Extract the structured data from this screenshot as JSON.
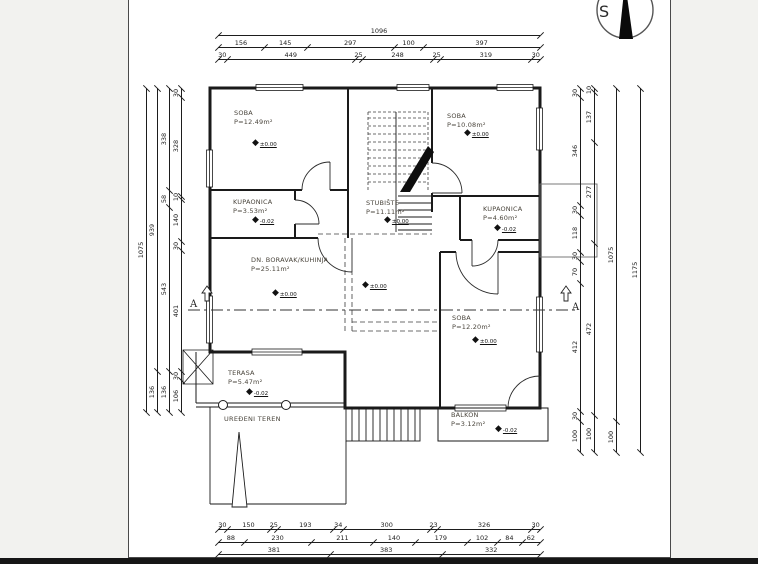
{
  "page": {
    "bg": "#f2f2ef",
    "sheet_bg": "#ffffff",
    "ink": "#1d1d1d"
  },
  "compass": {
    "label": "S"
  },
  "section_marker": {
    "label": "A"
  },
  "site_label": {
    "text": "UREĐENI TEREN"
  },
  "rooms": [
    {
      "id": "soba-tl",
      "name": "SOBA",
      "area": "P=12.49m²",
      "x": 234,
      "y": 109,
      "level": "±0.00",
      "lx": 252,
      "ly": 139
    },
    {
      "id": "kupaonica-left",
      "name": "KUPAONICA",
      "area": "P=3.53m²",
      "x": 233,
      "y": 198,
      "level": "-0.02",
      "lx": 252,
      "ly": 216
    },
    {
      "id": "stubiste",
      "name": "STUBIŠTE",
      "area": "P=11.11m²",
      "x": 366,
      "y": 199,
      "level": "±0.00",
      "lx": 384,
      "ly": 216
    },
    {
      "id": "soba-tr",
      "name": "SOBA",
      "area": "P=10.08m²",
      "x": 447,
      "y": 112,
      "level": "±0.00",
      "lx": 464,
      "ly": 129
    },
    {
      "id": "kupaonica-right",
      "name": "KUPAONICA",
      "area": "P=4.60m²",
      "x": 483,
      "y": 205,
      "level": "-0.02",
      "lx": 494,
      "ly": 224
    },
    {
      "id": "dn-boravak-kuhinja",
      "name": "DN. BORAVAK/KUHINJA",
      "area": "P=25.11m²",
      "x": 251,
      "y": 256,
      "level": "±0.00",
      "lx": 272,
      "ly": 289
    },
    {
      "id": "soba-br",
      "name": "SOBA",
      "area": "P=12.20m²",
      "x": 452,
      "y": 314,
      "level": "±0.00",
      "lx": 472,
      "ly": 336
    },
    {
      "id": "terasa",
      "name": "TERASA",
      "area": "P=5.47m²",
      "x": 228,
      "y": 369,
      "level": "-0.02",
      "lx": 246,
      "ly": 388
    },
    {
      "id": "balkon",
      "name": "BALKON",
      "area": "P=3.12m²",
      "x": 451,
      "y": 411,
      "level": "-0.02",
      "lx": 495,
      "ly": 425
    }
  ],
  "extra_levels": [
    {
      "value": "±0.00",
      "x": 362,
      "y": 281
    }
  ],
  "dims": {
    "rows": [
      {
        "id": "top-total",
        "dir": "h",
        "x": 218,
        "y": 35,
        "len": 322,
        "values": [
          "1096"
        ]
      },
      {
        "id": "top-mid",
        "dir": "h",
        "x": 218,
        "y": 47,
        "len": 322,
        "values": [
          "156",
          "145",
          "297",
          "100",
          "397"
        ]
      },
      {
        "id": "top-inner",
        "dir": "h",
        "x": 218,
        "y": 59,
        "len": 322,
        "values": [
          "30",
          "449",
          "25",
          "248",
          "25",
          "319",
          "30"
        ]
      },
      {
        "id": "bottom-inner",
        "dir": "h",
        "x": 218,
        "y": 529,
        "len": 322,
        "values": [
          "30",
          "150",
          "25",
          "193",
          "34",
          "300",
          "23",
          "326",
          "30"
        ]
      },
      {
        "id": "bottom-mid",
        "dir": "h",
        "x": 218,
        "y": 542,
        "len": 322,
        "values": [
          "88",
          "230",
          "211",
          "140",
          "179",
          "102",
          "84",
          "62"
        ]
      },
      {
        "id": "bottom-total",
        "dir": "h",
        "x": 218,
        "y": 554,
        "len": 322,
        "values": [
          "381",
          "383",
          "332"
        ]
      },
      {
        "id": "left-outer",
        "dir": "v",
        "x": 146,
        "y": 88,
        "len": 324,
        "values": [
          "1075"
        ]
      },
      {
        "id": "left-mid2",
        "dir": "v",
        "x": 157,
        "y": 88,
        "len": 324,
        "values": [
          "939",
          "136"
        ]
      },
      {
        "id": "left-mid1",
        "dir": "v",
        "x": 169,
        "y": 88,
        "len": 324,
        "values": [
          "338",
          "58",
          "543",
          "136"
        ]
      },
      {
        "id": "left-inner",
        "dir": "v",
        "x": 181,
        "y": 88,
        "len": 324,
        "values": [
          "30",
          "328",
          "10",
          "140",
          "30",
          "401",
          "30",
          "106"
        ]
      },
      {
        "id": "right-inner",
        "dir": "v",
        "x": 580,
        "y": 88,
        "len": 364,
        "values": [
          "30",
          "346",
          "30",
          "118",
          "30",
          "70",
          "412",
          "30",
          "100"
        ]
      },
      {
        "id": "right-mid1",
        "dir": "v",
        "x": 594,
        "y": 88,
        "len": 364,
        "values": [
          "10",
          "137",
          "277",
          "472",
          "100"
        ]
      },
      {
        "id": "right-mid2",
        "dir": "v",
        "x": 616,
        "y": 88,
        "len": 364,
        "values": [
          "1075",
          "100"
        ]
      },
      {
        "id": "right-outer",
        "dir": "v",
        "x": 640,
        "y": 88,
        "len": 364,
        "values": [
          "1175"
        ]
      }
    ]
  }
}
